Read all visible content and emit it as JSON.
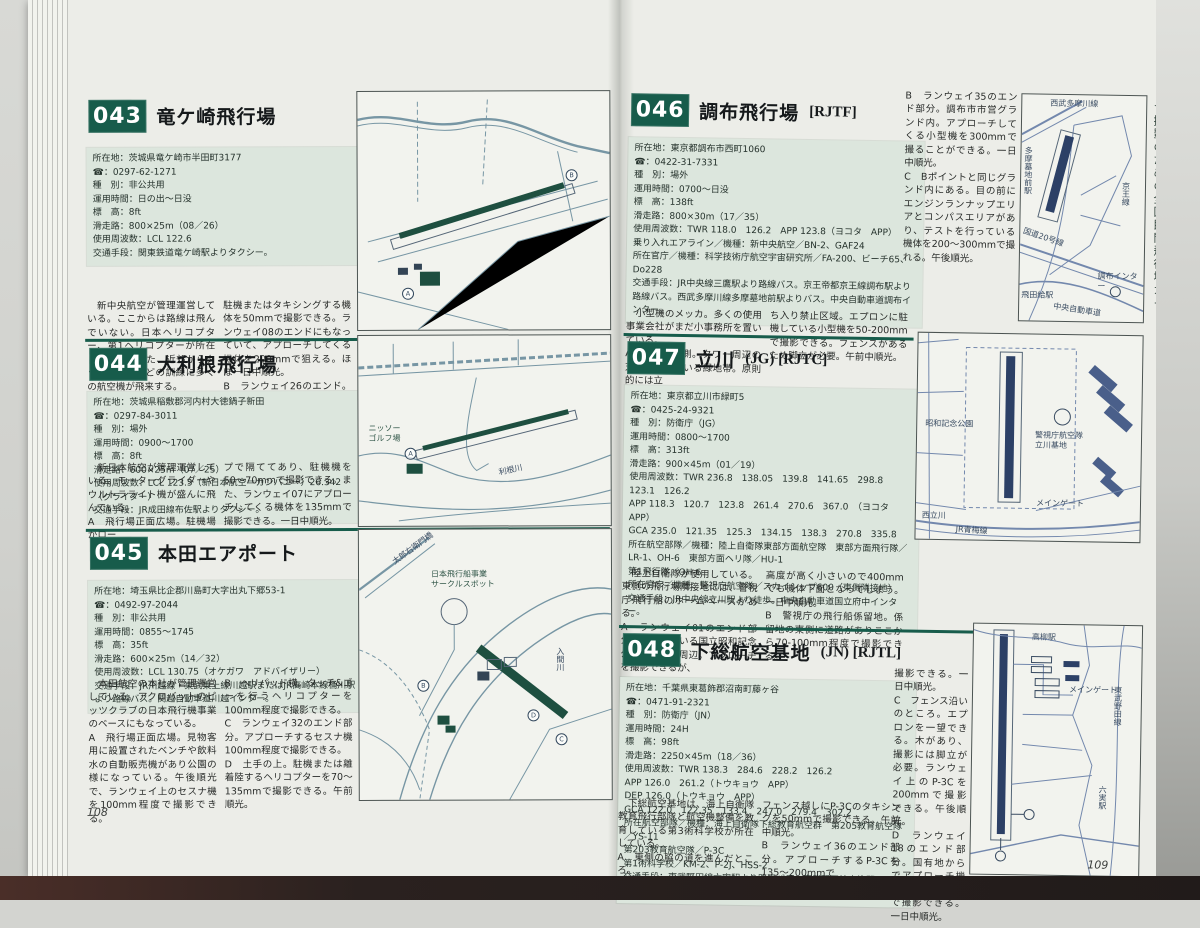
{
  "colors": {
    "accent_green": "#175c4b",
    "map_line_left": "#7796a4",
    "map_line_right": "#7388ad",
    "runway_left": "#1e4f40",
    "runway_right": "#2c4066",
    "info_bg": "#dce6dd"
  },
  "sidebar": {
    "title": "★撮影のための全国民間飛行場ガイド"
  },
  "pages": {
    "left": {
      "page_number": "108",
      "entries": [
        {
          "number": "043",
          "title": "竜ケ崎飛行場",
          "suffix": "",
          "info": "所在地：茨城県竜ケ崎市半田町3177\n☎：0297-62-1271\n種　別：非公共用\n運用時間：日の出〜日没\n標　高：8ft\n滑走路：800×25m（08／26）\n使用周波数：LCL 122.6\n交通手段：関東鉄道竜ケ崎駅よりタクシー。",
          "col1": "　新中央航空が管理運営している。ここからは路線は飛んでいない。日本ヘリコプター、第1ヘリコプターが所在している。また、近郊からタッチ&ゴーなどの訓練に多くの航空機が飛来する。\nA　飛行場正面の駐車場。エプロン全体を見ることができ、一番手前に",
          "col2": "駐機またはタキシングする機体を50mmで撮影できる。ランウェイ08のエンドにもなっていて、アプローチしてくる機体を200mmで狙える。ほぼ一日中順光。\nB　ランウェイ26のエンド。周囲のあぜ道のところで、アプローチしてくる機体を200mmで撮影できる。",
          "labels": {}
        },
        {
          "number": "044",
          "title": "大利根飛行場",
          "suffix": "",
          "info": "所在地：茨城県稲敷郡河内村大徳鍋子新田\n☎：0297-84-3011\n種　別：場外\n運用時間：0900〜1700\n標　高：8ft\n滑走路：600×25m（07／25）\n使用周波数：LCL 123.5（新日本航空＝カンパニー）26.342（グライダー）\n交通手段：JR成田線布佐駅よりタクシー。",
          "col1": "　新日本航空が管理運営している。モーターグライダーやウルトラライト機が盛んに飛んでいる。\nA　飛行場正面広場。駐機場がロー",
          "col2": "プで隔ててあり、駐機機を50〜70mmで撮影できる。また、ランウェイ07にアプローチしてくる機体を135mmで撮影できる。一日中順光。",
          "labels": {
            "golf": "ニッソー\nゴルフ場",
            "river": "利根川"
          }
        },
        {
          "number": "045",
          "title": "本田エアポート",
          "suffix": "",
          "info": "所在地：埼玉県比企郡川島町大字出丸下郷53-1\n☎：0492-97-2044\n種　別：非公共用\n運用時間：0855〜1745\n標　高：35ft\n滑走路：600×25m（14／32）\n使用周波数：LCL 130.75（オケガワ　アドバイザリー）\n交通手段：JR川越線・東武東上線川越駅またはJR高崎本線桶川駅より路線バス。関越自動車道川越インター。",
          "col1": "　本田航空の本社が管理運営している。アクロバットのピッツクラブの日本飛行機事業のベースにもなっている。\nA　飛行場正面広場。見物客用に設置されたベンチや飲料水の自動販売機があり公園の様になっている。午後順光で、ランウェイ上のセスナ機を100mm程度で撮影できる。",
          "col2": "B　ヘリパッド横。タッチ&ゴーを行うヘリコプターを100mm程度で撮影できる。\nC　ランウェイ32のエンド部分。アプローチするセスナ機100mm程度で撮影できる。\nD　土手の上。駐機または離着陸するヘリコプターを70〜135mmで撮影できる。午前順光。",
          "labels": {
            "spot": "日本飛行船事業\nサークルスポット",
            "bridge": "太郎右衛門橋",
            "river": "入間川"
          }
        }
      ]
    },
    "right": {
      "page_number": "109",
      "entries": [
        {
          "number": "046",
          "title": "調布飛行場",
          "suffix": "[RJTF]",
          "info": "所在地：東京都調布市西町1060\n☎：0422-31-7331\n種　別：場外\n運用時間：0700〜日没\n標　高：138ft\n滑走路：800×30m（17／35）\n使用周波数：TWR 118.0　126.2　APP 123.8（ヨコタ　APP）\n乗り入れエアライン／機種：新中央航空／BN-2、GAF24\n所在官庁／機種：科学技術庁航空宇宙研究所／FA-200、ビーチ65、Do228\n交通手段：JR中央線三鷹駅より路線バス。京王帝都京王線調布駅より路線バス。西武多摩川線多摩墓地前駅よりバス。中央自動車道調布インター。",
          "col1": "　小型機のメッカ。多くの使用事業会社がまだ小事務所を置いている。\nA　飛行場東側。タワー周辺の芝地になっている緑地帯。原則的には立",
          "col2": "ち入り禁止区域。エプロンに駐機している小型機を50-200mmで撮影できる。フェンスがあるため脚立が必要。午前中順光。",
          "col3": "B　ランウェイ35のエンド部分。調布市市営グランド内。アプローチしてくる小型機を300mmで撮ることができる。一日中順光。\nC　Bポイントと同じグランド内にある。目の前にエンジンランナップエリアとコンパスエリアがあり、テストを行っている機体を200〜300mmで撮れる。午後順光。",
          "labels": {
            "station": "多摩墓地前駅",
            "rail": "西武多摩川線",
            "road20": "国道20号線",
            "tobitakyu": "飛田給駅",
            "expressway": "中央自動車道",
            "interchange": "調布インター",
            "keio": "京王線"
          }
        },
        {
          "number": "047",
          "title": "立川",
          "suffix": "(JG) [RJTC]",
          "info": "所在地：東京都立川市緑町5\n☎：0425-24-9321\n種　別：防衛庁（JG）\n運用時間：0800〜1700\n標　高：313ft\n滑走路：900×45m（01／19）\n使用周波数：TWR 236.8　138.05　139.8　141.65　298.8　123.1　126.2\nAPP 118.3　120.7　123.8　261.4　270.6　367.0　（ヨコタ　APP）\nGCA 235.0　121.35　125.3　134.15　138.3　270.8　335.8\n所在航空部隊／機種：陸上自衛隊東部方面航空隊　東部方面飛行隊／LR-1、OH-6　東部方面ヘリ隊／HU-1\n第1飛行隊／OH-6\n所在官庁／機種：警視庁航空隊／スカイシップ600（東側隣接地）\n交通手段：JR中央線立川駅より徒歩。中央自動車道国立府中インター。",
          "col1": "　陸上自衛隊が使用している。東側の飛行場隣接地には、警視庁飛行船のホームベースがある。\nA　ランウェイ01のエンド部分。隣接している国立昭和記念公園の駐車場周辺。アプローチを撮影できるが、",
          "col2": "高度が高く小さいので400mmでも機体下面となってしまう。一日中順光。\nB　警視庁の飛行船係留地。係留地の東側に道路がありここから70-100mm程度で撮影できる。",
          "col3": "",
          "labels": {
            "park": "昭和記念公園",
            "police": "警視庁航空隊\n立川基地",
            "gate": "メインゲート",
            "nishitachikawa": "西立川",
            "rail": "JR青梅線"
          }
        },
        {
          "number": "048",
          "title": "下総航空基地",
          "suffix": "(JN) [RJTL]",
          "info": "所在地：千葉県東葛飾郡沼南町藤ヶ谷\n☎：0471-91-2321\n種　別：防衛庁（JN）\n運用時間：24H\n標　高：98ft\n滑走路：2250×45m（18／36）\n使用周波数：TWR 138.3　284.6　228.2　126.2\nAPP 126.0　261.2（トウキョウ　APP）\nDEP 126.0（トウキョウ　APP）\nGCA 122.0　122.35　133.4　247.0　279.4　302.2\n所在航空部隊／機種：海上自衛隊下総教育航空群　第205教育航空隊／YS-11\n第203教育航空隊／P-3C\n第1術科学校／KM-2、P-2J、HSS-2\n交通手段：東武野田線六実駅より路線バス。東武野田線高柳駅より徒歩。",
          "col1": "　下総航空基地は、海上自衛隊教育飛行部隊と航空機整備を教育している第3術科学校が所在している。\nA　東側の脇の道を進んだところ。",
          "col2": "フェンス越しにP-3Cのタキシングを50mmで撮影できる。午前中順光。\nB　ランウェイ36のエンド部分。アプローチするP-3Cを135〜200mmで",
          "col3": "撮影できる。一日中順光。\nC　フェンス沿いのところ。エプロンを一望できる。木があり、撮影には脚立が必要。ランウェイ上のP-3Cを200mmで撮影できる。午後順光。\nD　ランウェイ18のエンド部分。国有地からでアプローチ機を135-200mmで撮影できる。一日中順光。",
          "labels": {
            "takayanagi": "高柳駅",
            "rail": "東武野田線",
            "mutsumi": "六実駅",
            "gate": "メインゲート"
          }
        }
      ]
    }
  }
}
